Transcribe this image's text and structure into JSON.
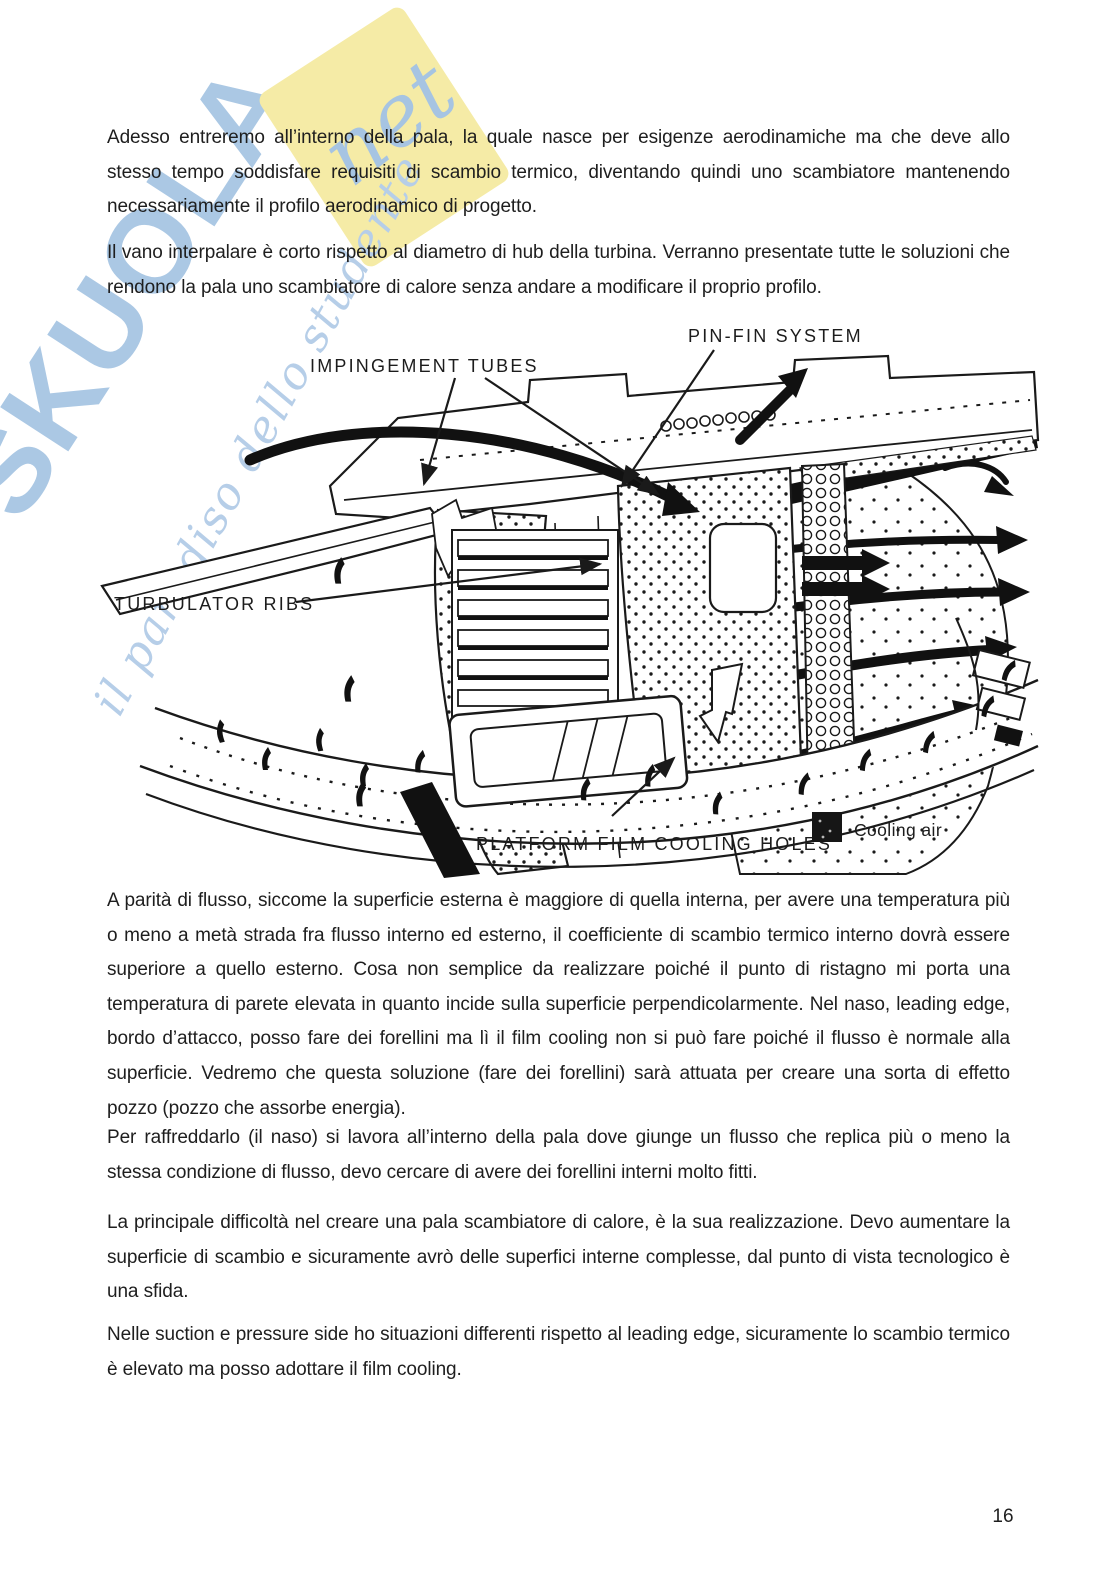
{
  "page": {
    "number": "16"
  },
  "watermark": {
    "brand": "SKUOLA",
    "brand_note": "net",
    "tagline": "il paradiso dello studente",
    "colors": {
      "blue": "#abc8e4",
      "yellow": "#f5eba6"
    }
  },
  "paragraphs": {
    "p1": "Adesso entreremo all’interno della pala, la quale nasce per esigenze aerodinamiche ma che deve allo stesso tempo soddisfare requisiti di scambio termico, diventando quindi uno scambiatore mantenendo necessariamente il profilo aerodinamico di progetto.",
    "p2": "Il vano interpalare è corto rispetto al diametro di hub della turbina. Verranno presentate tutte le soluzioni che rendono la pala uno scambiatore di calore senza andare a modificare il proprio profilo.",
    "p3": "A parità di flusso, siccome la superficie esterna è maggiore di quella interna, per avere una temperatura più o meno a metà strada fra flusso interno ed esterno, il coefficiente di scambio termico interno dovrà essere superiore a quello esterno. Cosa non semplice da realizzare poiché il punto di ristagno mi porta una temperatura di parete elevata in quanto incide sulla superficie perpendicolarmente. Nel naso, leading edge, bordo d’attacco, posso fare dei forellini ma lì il film cooling non si può fare poiché il flusso è normale alla superficie. Vedremo che questa soluzione (fare dei forellini) sarà attuata per creare una sorta di effetto pozzo (pozzo che assorbe energia).",
    "p4": "Per raffreddarlo (il naso) si lavora all’interno della pala dove giunge un flusso che replica più o meno la stessa condizione di flusso, devo cercare di avere dei forellini interni molto fitti.",
    "p5": "La principale difficoltà nel creare una pala scambiatore di calore, è la sua realizzazione. Devo aumentare la superficie di scambio e sicuramente avrò delle superfici interne complesse, dal punto di vista tecnologico è una sfida.",
    "p6": "Nelle suction e pressure side ho situazioni differenti rispetto al leading edge, sicuramente lo scambio termico è elevato ma posso adottare il film cooling."
  },
  "figure": {
    "labels": {
      "impingement_tubes": "IMPINGEMENT TUBES",
      "pin_fin_system": "PIN-FIN SYSTEM",
      "turbulator_ribs": "TURBULATOR RIBS",
      "platform_film_cooling_holes": "PLATFORM FILM COOLING HOLES",
      "cooling_air": "Cooling air"
    }
  }
}
